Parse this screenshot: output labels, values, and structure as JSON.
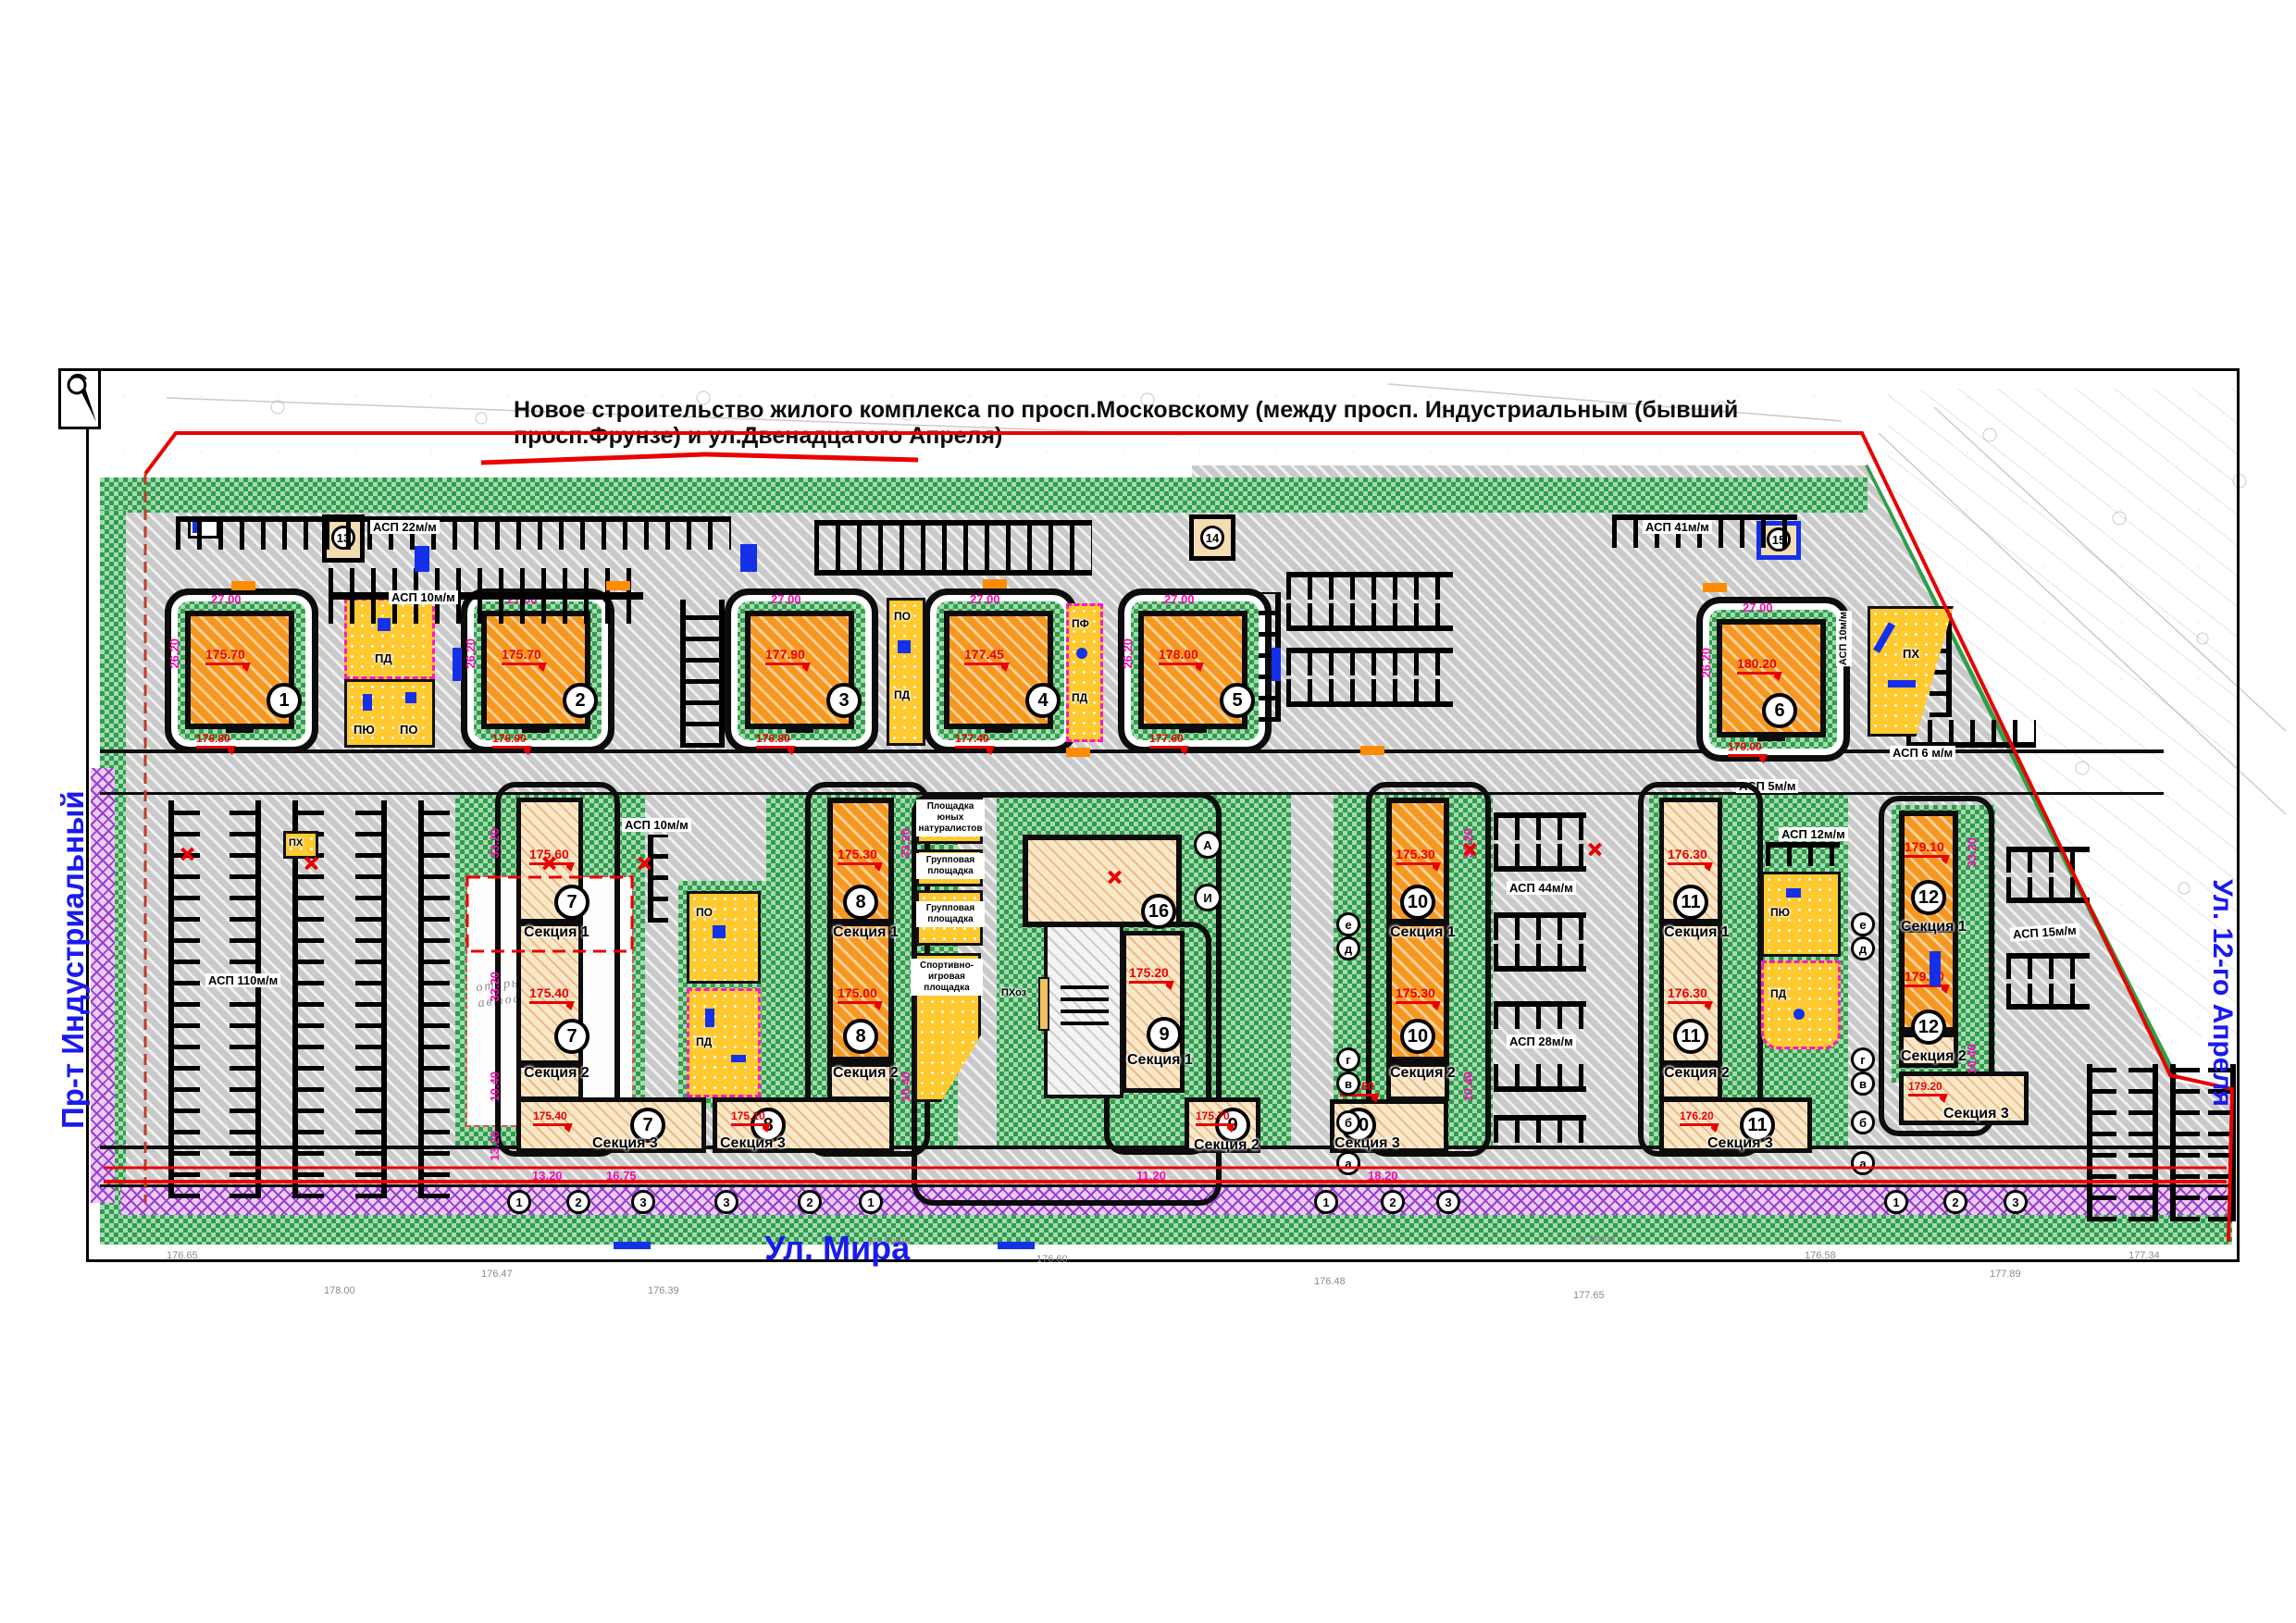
{
  "title": "Новое строительство жилого комплекса по просп.Московскому (между просп. Индустриальным (бывший просп.Фрунзе)   и ул.Двенадцатого Апреля)",
  "streets": {
    "left": "Пр-т Индустриальный",
    "bottom": "Ул. Мира",
    "right": "Ул. 12-го Апреля",
    "survey1": "ул. Мира",
    "survey2": "ул. Мира"
  },
  "top_buildings": [
    {
      "num": "1",
      "elev": "175.70",
      "elev2": "176.80"
    },
    {
      "num": "2",
      "elev": "175.70",
      "elev2": "176.90"
    },
    {
      "num": "3",
      "elev": "177.90",
      "elev2": "176.80"
    },
    {
      "num": "4",
      "elev": "177.45",
      "elev2": "177.40"
    },
    {
      "num": "5",
      "elev": "178.00",
      "elev2": "177.60"
    },
    {
      "num": "6",
      "elev": "180.20",
      "elev2": "179.00"
    }
  ],
  "lower_buildings": [
    {
      "num": "7",
      "s1": "Секция 1",
      "s2": "Секция 2",
      "s3": "Секция 3",
      "e1": "175.60",
      "e2": "175.40",
      "e3": "175.40"
    },
    {
      "num": "8",
      "s1": "Секция 1",
      "s2": "Секция 2",
      "s3": "Секция 3",
      "e1": "175.30",
      "e2": "175.00",
      "e3": "175.10"
    },
    {
      "num": "9",
      "s1": "Секция 1",
      "s2": "Секция 2",
      "e1": "175.20",
      "e2": "175.70"
    },
    {
      "num": "10",
      "s1": "Секция 1",
      "s2": "Секция 2",
      "s3": "Секция 3",
      "e1": "175.30",
      "e2": "175.30",
      "e3": "175.80"
    },
    {
      "num": "11",
      "s1": "Секция 1",
      "s2": "Секция 2",
      "s3": "Секция 3",
      "e1": "176.30",
      "e2": "176.30",
      "e3": "176.20"
    },
    {
      "num": "12",
      "s1": "Секция 1",
      "s2": "Секция 2",
      "s3": "Секция 3",
      "e1": "179.10",
      "e2": "179.20",
      "e3": "179.20"
    }
  ],
  "kindergarten": {
    "num": "16",
    "area1": "Площадка юных натуралистов",
    "area2": "Групповая площадка",
    "area3": "Групповая площадка",
    "area4": "Спортивно-игровая площадка",
    "util": "ПХоз"
  },
  "service": {
    "n13": "13",
    "n14": "14",
    "n15": "15"
  },
  "codes": {
    "pd": "ПД",
    "po": "ПО",
    "pf": "ПФ",
    "px": "ПХ",
    "pyu": "ПЮ"
  },
  "parking": {
    "a22": "АСП 22м/м",
    "a10": "АСП 10м/м",
    "a110": "АСП 110м/м",
    "a41": "АСП 41м/м",
    "a6": "АСП 6 м/м",
    "a5": "АСП 5м/м",
    "a44": "АСП 44м/м",
    "a28": "АСП 28м/м",
    "a12": "АСП 12м/м",
    "a15": "АСП 15м/м"
  },
  "open_parking": "открытая автостоянка",
  "dims": {
    "w27": "27.00",
    "h262": "26.20",
    "v332": "33.20",
    "v104": "10.40",
    "v132": "13.20",
    "b1675": "16.75",
    "b182": "18.20",
    "b112": "11.20"
  },
  "axis": {
    "n1": "1",
    "n2": "2",
    "n3": "3",
    "le": "е",
    "ld": "д",
    "lg": "г",
    "lv": "в",
    "lb": "б",
    "la": "а",
    "lA": "А",
    "lI": "И"
  },
  "survey_marks": [
    "176.65",
    "176.47",
    "176.39",
    "176.60",
    "176.48",
    "177.65",
    "176.58",
    "177.89",
    "177.34",
    "178.00"
  ]
}
